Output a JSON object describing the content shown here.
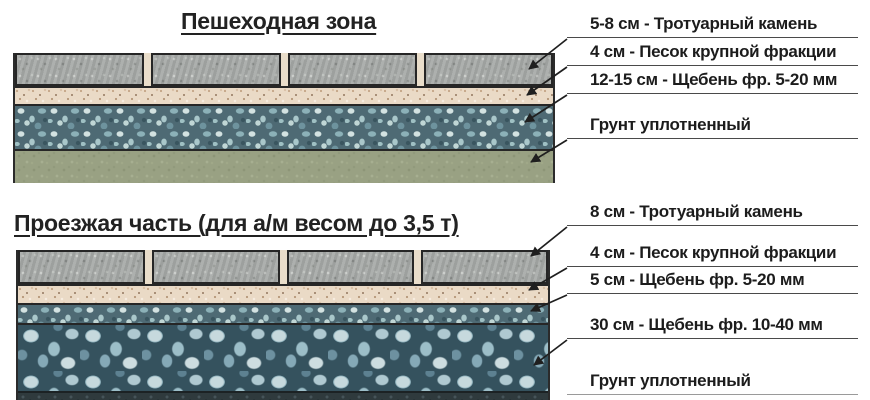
{
  "page": {
    "background": "#ffffff",
    "text_color": "#1c1c1c",
    "line_color": "#1f1f1f"
  },
  "sections": [
    {
      "title": "Пешеходная зона",
      "labels": [
        "5-8 см - Тротуарный камень",
        "4 см - Песок крупной фракции",
        "12-15 см - Щебень фр. 5-20 мм",
        "Грунт уплотненный"
      ],
      "layers": [
        {
          "name": "Тротуарный камень",
          "color": "#a7aaa8"
        },
        {
          "name": "Песок крупной фракции",
          "color": "#eadac6"
        },
        {
          "name": "Щебень фр. 5-20 мм",
          "color": "#6f949f"
        },
        {
          "name": "Грунт уплотненный",
          "color": "#99a183"
        }
      ]
    },
    {
      "title": "Проезжая часть (для а/м весом до 3,5 т)",
      "labels": [
        "8 см - Тротуарный камень",
        "4 см - Песок крупной фракции",
        "5 см - Щебень фр. 5-20 мм",
        "30 см - Щебень фр. 10-40 мм",
        "Грунт уплотненный"
      ],
      "layers": [
        {
          "name": "Тротуарный камень",
          "color": "#a7aaa8"
        },
        {
          "name": "Песок крупной фракции",
          "color": "#eadac6"
        },
        {
          "name": "Щебень фр. 5-20 мм",
          "color": "#6f949f"
        },
        {
          "name": "Щебень фр. 10-40 мм",
          "color": "#4a6673"
        },
        {
          "name": "Грунт уплотненный",
          "color": "#2f3a3d"
        }
      ]
    }
  ]
}
